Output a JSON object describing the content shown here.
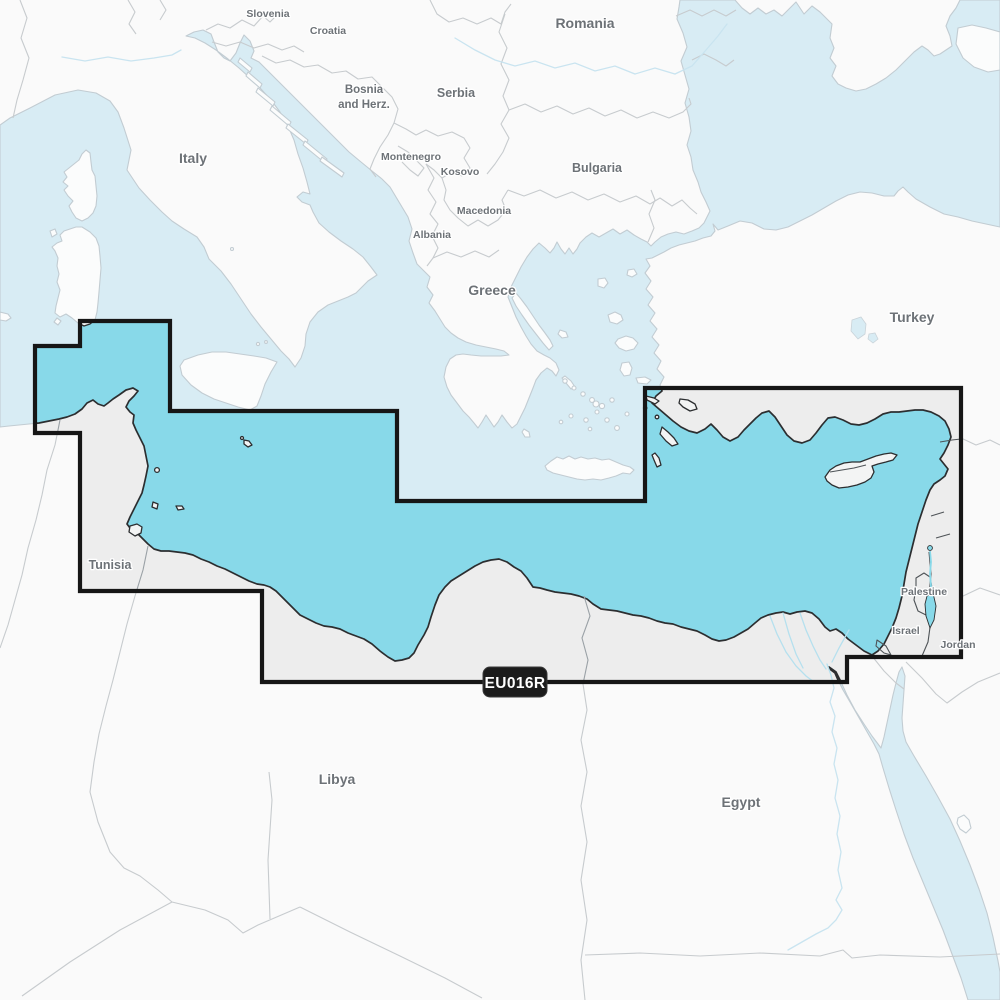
{
  "map": {
    "region_code_label": "EU016R",
    "labels": [
      {
        "text": "Slovenia",
        "x": 268,
        "y": 17,
        "size": "s"
      },
      {
        "text": "Croatia",
        "x": 328,
        "y": 34,
        "size": "s"
      },
      {
        "text": "Bosnia",
        "x": 364,
        "y": 93,
        "size": "m"
      },
      {
        "text": "and Herz.",
        "x": 364,
        "y": 108,
        "size": "m"
      },
      {
        "text": "Serbia",
        "x": 456,
        "y": 97,
        "size": "l"
      },
      {
        "text": "Montenegro",
        "x": 411,
        "y": 160,
        "size": "s"
      },
      {
        "text": "Kosovo",
        "x": 460,
        "y": 175,
        "size": "s"
      },
      {
        "text": "Macedonia",
        "x": 484,
        "y": 214,
        "size": "s"
      },
      {
        "text": "Albania",
        "x": 432,
        "y": 238,
        "size": "s"
      },
      {
        "text": "Italy",
        "x": 193,
        "y": 163,
        "size": "xl"
      },
      {
        "text": "Romania",
        "x": 585,
        "y": 28,
        "size": "xl"
      },
      {
        "text": "Bulgaria",
        "x": 597,
        "y": 172,
        "size": "l"
      },
      {
        "text": "Greece",
        "x": 492,
        "y": 295,
        "size": "xl"
      },
      {
        "text": "Turkey",
        "x": 912,
        "y": 322,
        "size": "xl"
      },
      {
        "text": "Tunisia",
        "x": 110,
        "y": 569,
        "size": "l"
      },
      {
        "text": "Libya",
        "x": 337,
        "y": 784,
        "size": "xl"
      },
      {
        "text": "Egypt",
        "x": 741,
        "y": 807,
        "size": "xl"
      },
      {
        "text": "Palestine",
        "x": 924,
        "y": 595,
        "size": "s"
      },
      {
        "text": "Israel",
        "x": 906,
        "y": 634,
        "size": "s"
      },
      {
        "text": "Jordan",
        "x": 958,
        "y": 648,
        "size": "s"
      }
    ],
    "colors": {
      "coverage_sea": "#88d9e9",
      "coverage_land": "#ededed",
      "coverage_border": "#161616",
      "sea": "#d8ecf4",
      "land": "#fafafa",
      "label": "#6d7277",
      "badge_bg": "#1c1c1c",
      "badge_text": "#ffffff"
    }
  }
}
